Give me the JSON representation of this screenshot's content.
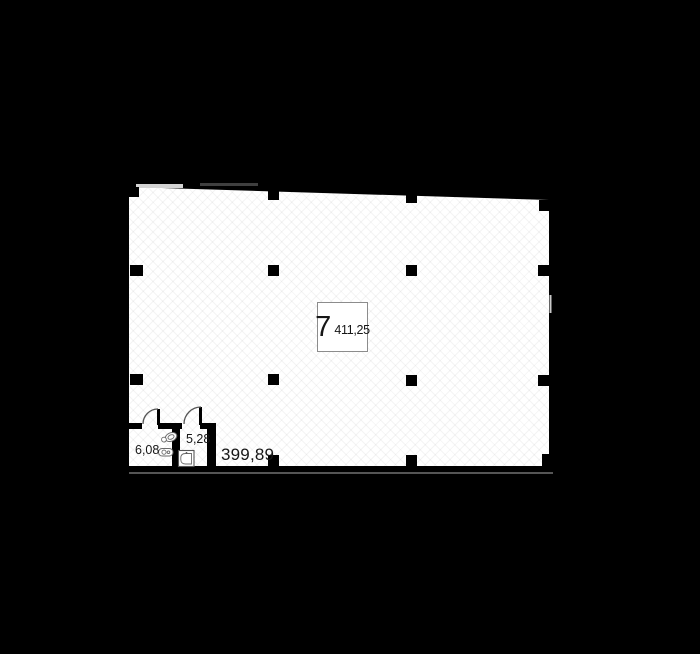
{
  "title": "apartment-floor-plan",
  "colors": {
    "background": "#000000",
    "floor": "#ffffff",
    "walls": "#000000",
    "text": "#161616",
    "label_box_border": "#8c8c8c",
    "fixture": "#6a6a6a",
    "arc": "#555555"
  },
  "unit_label": {
    "number": "7",
    "area": "411,25"
  },
  "main_room": {
    "area_label": "399,89"
  },
  "small_rooms": [
    {
      "name": "bathroom-left",
      "area_label": "6,08"
    },
    {
      "name": "bathroom-right",
      "area_label": "5,28"
    }
  ],
  "icons": [
    {
      "name": "toilet-icon"
    },
    {
      "name": "sink-icon"
    },
    {
      "name": "washbasin-icon"
    },
    {
      "name": "door-swing-left-icon"
    },
    {
      "name": "door-swing-right-icon"
    },
    {
      "name": "window-marker-icon"
    }
  ]
}
